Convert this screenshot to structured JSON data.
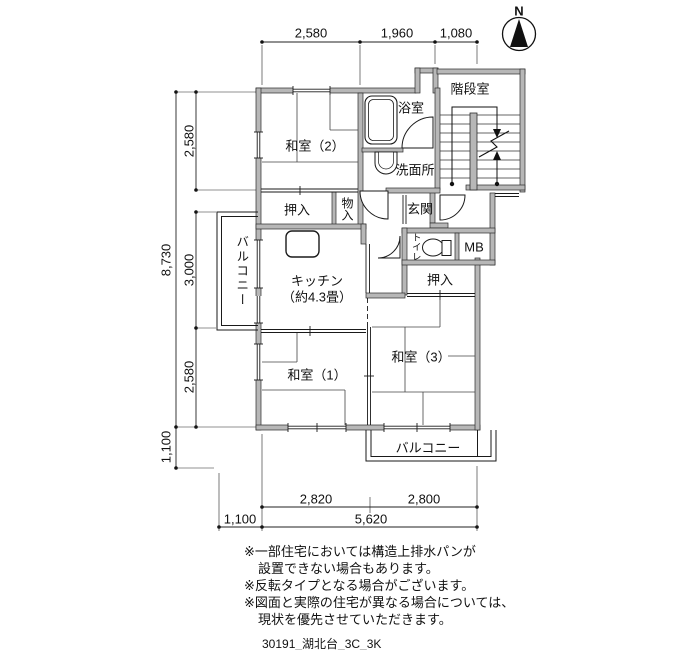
{
  "colors": {
    "wall_fill": "#b7b7b7",
    "line": "#1a1a1a"
  },
  "north": {
    "label": "N"
  },
  "dims": {
    "top": [
      "2,580",
      "1,960",
      "1,080"
    ],
    "left_total": "8,730",
    "left_segments": [
      "2,580",
      "3,000",
      "2,580"
    ],
    "left_offset": "1,100",
    "bottom_widths": [
      "2,820",
      "2,800"
    ],
    "bottom_offset": "1,100",
    "bottom_total": "5,620"
  },
  "rooms": {
    "stairwell": "階段室",
    "bath": "浴室",
    "washroom": "洗面所",
    "washitsu2": "和室（2）",
    "closet_top": "押入",
    "storage": "物入",
    "entrance": "玄関",
    "toilet": "トイレ",
    "meter_box": "MB",
    "kitchen": "キッチン",
    "kitchen_size": "（約4.3畳）",
    "closet_right": "押入",
    "washitsu1": "和室（1）",
    "washitsu3": "和室（3）",
    "balcony_left": "バルコニー",
    "balcony_bottom": "バルコニー"
  },
  "notes": [
    "※一部住宅においては構造上排水パンが",
    "設置できない場合もあります。",
    "※反転タイプとなる場合がございます。",
    "※図面と実際の住宅が異なる場合については、",
    "現状を優先させていただきます。"
  ],
  "footer": "30191_湖北台_3C_3K"
}
